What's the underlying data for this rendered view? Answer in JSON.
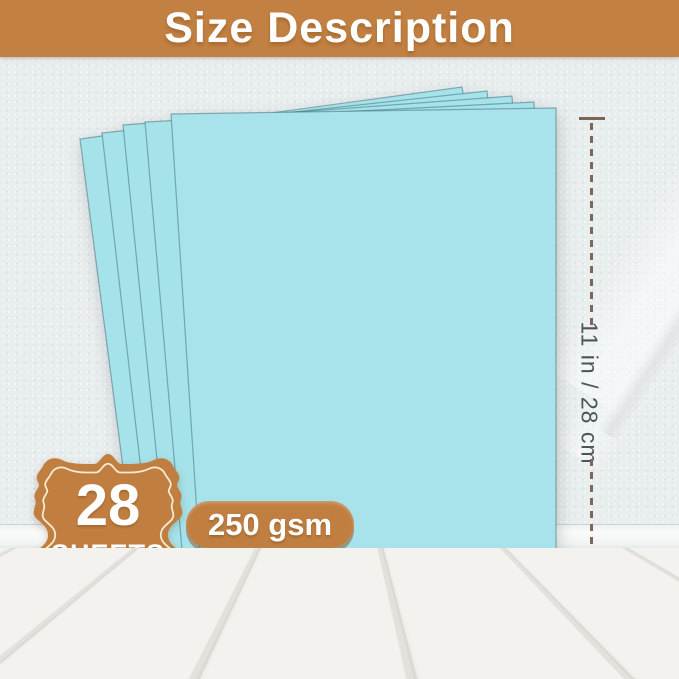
{
  "banner": {
    "title": "Size Description"
  },
  "paper": {
    "sheet_count": "28",
    "sheet_count_unit": "SHEETS",
    "weight": "250 gsm",
    "color_hex": "#a6e2ea",
    "sheets_visible": 5
  },
  "dimensions": {
    "height_label": "11 in / 28 cm",
    "width_label": "8.5 in / 21.6 cm"
  },
  "colors": {
    "accent_brown": "#c28142",
    "badge_brown": "#c07f41",
    "dimension_line_brown": "#7d5c48",
    "dimension_text_gray": "#4c555a",
    "wall": "#e8edee",
    "floor": "#f2f1ee"
  }
}
